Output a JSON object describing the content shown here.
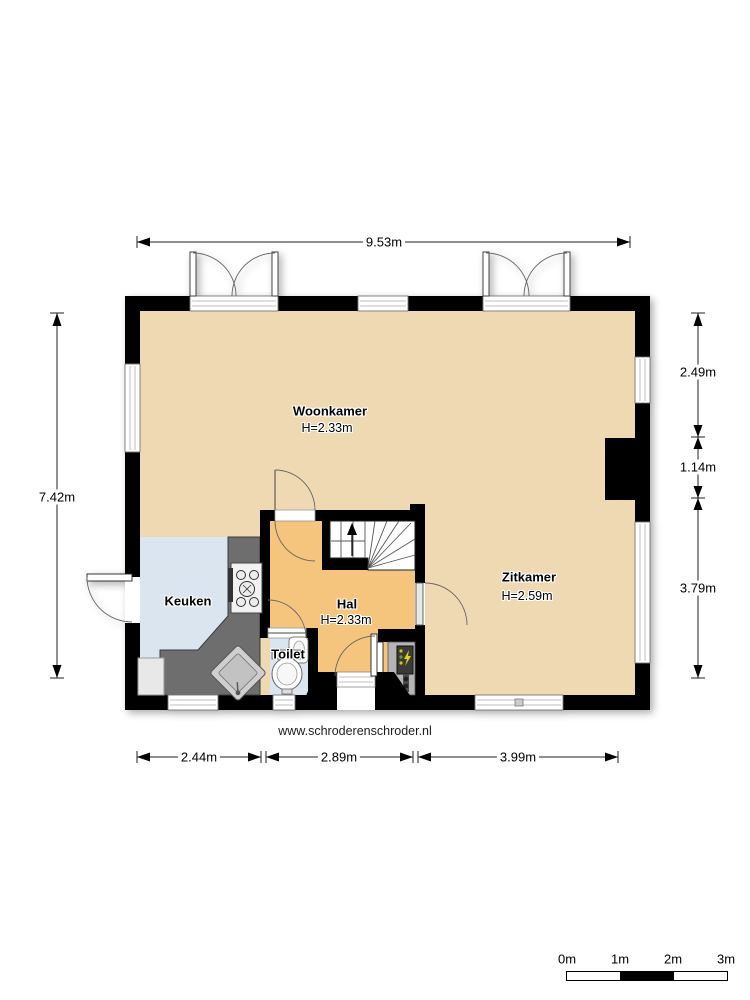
{
  "plan": {
    "website": "www.schroderenschroder.nl",
    "rooms": [
      {
        "name": "Woonkamer",
        "height": "H=2.33m"
      },
      {
        "name": "Zitkamer",
        "height": "H=2.59m"
      },
      {
        "name": "Keuken"
      },
      {
        "name": "Hal",
        "height": "H=2.33m"
      },
      {
        "name": "Toilet"
      }
    ],
    "dimensions": {
      "top": "9.53m",
      "left": "7.42m",
      "right": [
        "2.49m",
        "1.14m",
        "3.79m"
      ],
      "bottom": [
        "2.44m",
        "2.89m",
        "3.99m"
      ]
    },
    "scale_bar": [
      "0m",
      "1m",
      "2m",
      "3m"
    ],
    "colors": {
      "floor_living": "#efd9b3",
      "floor_hall": "#f5c57e",
      "floor_wet": "#dbe5f0",
      "counter": "#6e6e6e",
      "wall": "#000000"
    }
  }
}
